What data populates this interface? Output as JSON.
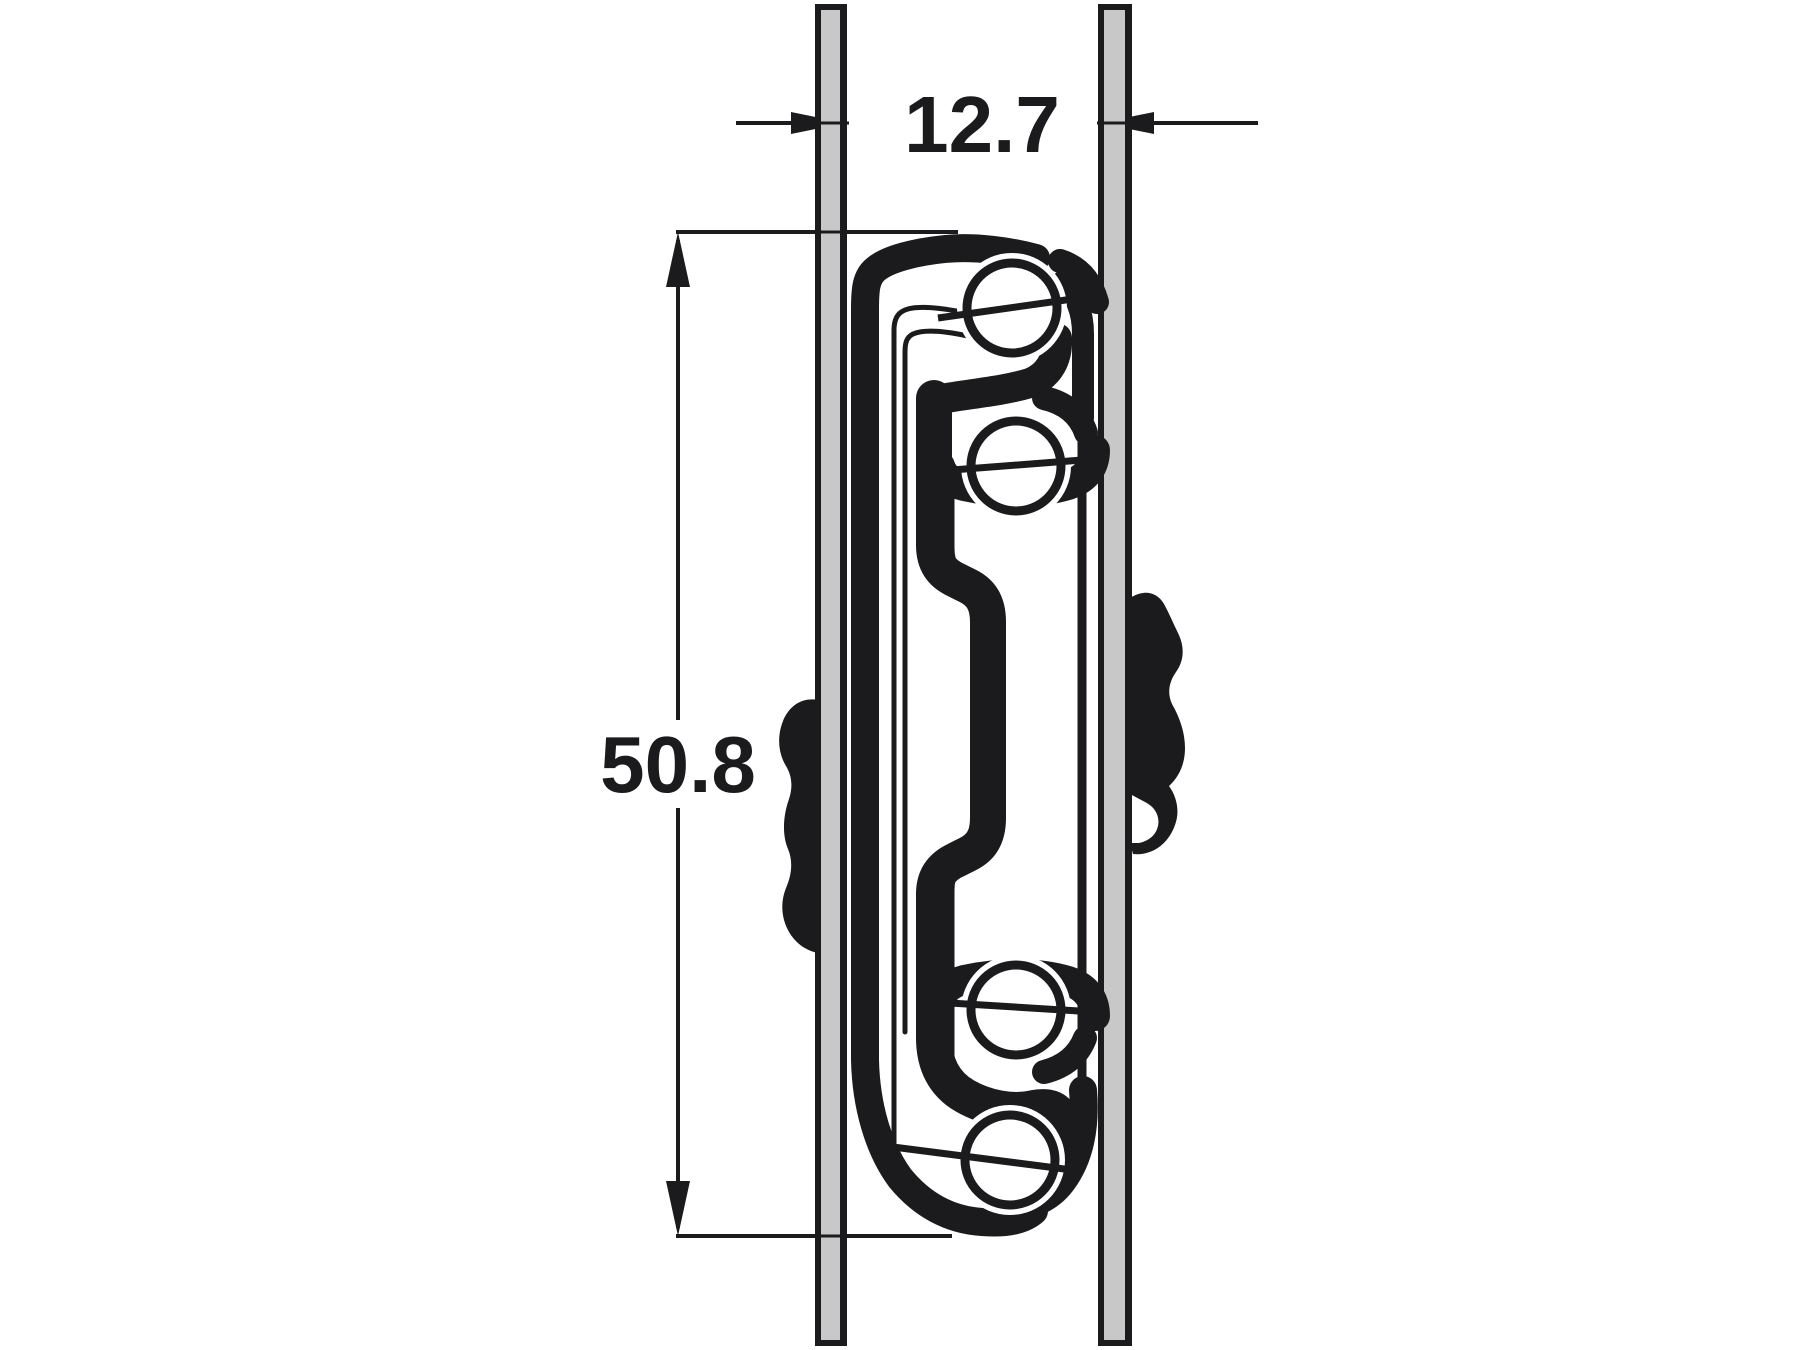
{
  "diagram": {
    "type": "technical-cross-section-drawing",
    "subject": "Ball bearing drawer runner cross section mounted between two panels",
    "dimensions": {
      "gap_width_mm": "12.7",
      "slide_height_mm": "50.8"
    },
    "ball_bearing_count": 4,
    "colors": {
      "ink": "#1b1b1d",
      "panel_fill": "#c7c8c7",
      "background": "#ffffff"
    }
  }
}
